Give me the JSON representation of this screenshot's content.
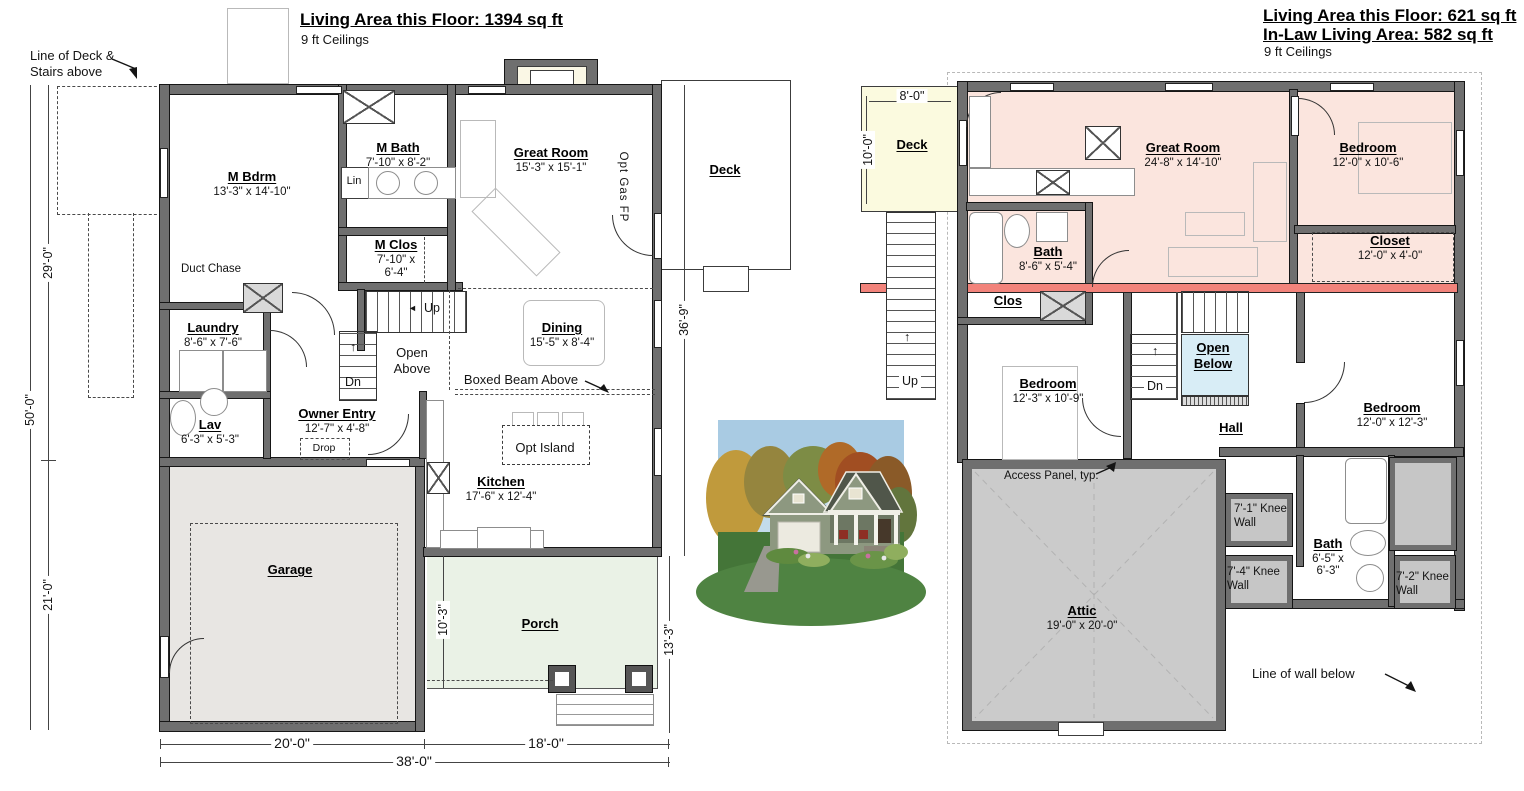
{
  "header_left": {
    "title": "Living Area this Floor: 1394 sq ft",
    "subtitle": "9 ft Ceilings"
  },
  "header_right": {
    "title": "Living Area this Floor: 621 sq ft",
    "title2": "In-Law Living Area: 582 sq ft",
    "subtitle": "9 ft Ceilings"
  },
  "f1": {
    "note_deck_line1": "Line of Deck &",
    "note_deck_line2": "Stairs above",
    "m_bdrm_name": "M Bdrm",
    "m_bdrm_dim": "13'-3\" x 14'-10\"",
    "m_bath_name": "M Bath",
    "m_bath_dim": "7'-10\" x 8'-2\"",
    "lin": "Lin",
    "m_clos_name": "M Clos",
    "m_clos_dim1": "7'-10\" x",
    "m_clos_dim2": "6'-4\"",
    "great_room_name": "Great Room",
    "great_room_dim": "15'-3\" x 15'-1\"",
    "opt_gas_fp": "Opt Gas FP",
    "deck_name": "Deck",
    "duct_chase": "Duct Chase",
    "laundry_name": "Laundry",
    "laundry_dim": "8'-6\" x 7'-6\"",
    "lav_name": "Lav",
    "lav_dim": "6'-3\" x 5'-3\"",
    "owner_entry_name": "Owner Entry",
    "owner_entry_dim": "12'-7\" x 4'-8\"",
    "drop": "Drop",
    "up": "Up",
    "dn": "Dn",
    "open_above1": "Open",
    "open_above2": "Above",
    "dining_name": "Dining",
    "dining_dim": "15'-5\" x 8'-4\"",
    "boxed_beam": "Boxed Beam Above",
    "opt_island": "Opt Island",
    "kitchen_name": "Kitchen",
    "kitchen_dim": "17'-6\" x 12'-4\"",
    "garage_name": "Garage",
    "porch_name": "Porch",
    "dim_29": "29'-0\"",
    "dim_50": "50'-0\"",
    "dim_21": "21'-0\"",
    "dim_36_9": "36'-9\"",
    "dim_13_3": "13'-3\"",
    "dim_10_3": "10'-3\"",
    "dim_20": "20'-0\"",
    "dim_18": "18'-0\"",
    "dim_38": "38'-0\""
  },
  "f2": {
    "deck_name": "Deck",
    "dim_8": "8'-0\"",
    "dim_10": "10'-0\"",
    "up": "Up",
    "great_room_name": "Great Room",
    "great_room_dim": "24'-8\" x 14'-10\"",
    "bedroom_ne_name": "Bedroom",
    "bedroom_ne_dim": "12'-0\" x 10'-6\"",
    "bath1_name": "Bath",
    "bath1_dim": "8'-6\" x 5'-4\"",
    "closet_name": "Closet",
    "closet_dim": "12'-0\" x 4'-0\"",
    "clos": "Clos",
    "bedroom_w_name": "Bedroom",
    "bedroom_w_dim": "12'-3\" x 10'-9\"",
    "open_below1": "Open",
    "open_below2": "Below",
    "dn": "Dn",
    "hall": "Hall",
    "bedroom_se_name": "Bedroom",
    "bedroom_se_dim": "12'-0\" x 12'-3\"",
    "access_panel": "Access Panel, typ.",
    "attic_name": "Attic",
    "attic_dim": "19'-0\" x 20'-0\"",
    "knee1a": "7'-1\" Knee",
    "knee1b": "Wall",
    "knee2a": "7'-4\" Knee",
    "knee2b": "Wall",
    "knee3a": "7'-2\" Knee",
    "knee3b": "Wall",
    "bath2_name": "Bath",
    "bath2_dim1": "6'-5\" x",
    "bath2_dim2": "6'-3\"",
    "line_wall_below": "Line of wall below"
  },
  "colors": {
    "wall_gray": "#6f6f6f",
    "wall_red": "#f2837b",
    "inlaw_pink": "#fbe5de",
    "deck_yellow": "#fbfadf",
    "open_below_blue": "#d8edf6",
    "attic_gray": "#cbcbcb",
    "garage_gray": "#e8e6e3",
    "porch_green": "#eaf2e6"
  }
}
